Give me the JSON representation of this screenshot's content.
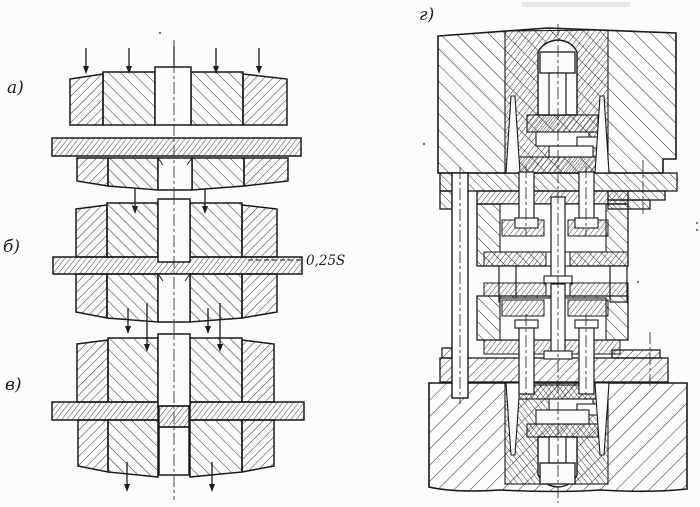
{
  "figure": {
    "type": "technical-drawing",
    "panels": [
      {
        "id": "a",
        "label": "а)"
      },
      {
        "id": "b",
        "label": "б)"
      },
      {
        "id": "v",
        "label": "в)"
      },
      {
        "id": "g",
        "label": "г)"
      }
    ],
    "annotations": {
      "penetration_depth": "0,25S"
    },
    "colors": {
      "ink": "#1c1c1c",
      "paper": "#fcfcfa",
      "hatch": "#2e2e2e"
    }
  }
}
